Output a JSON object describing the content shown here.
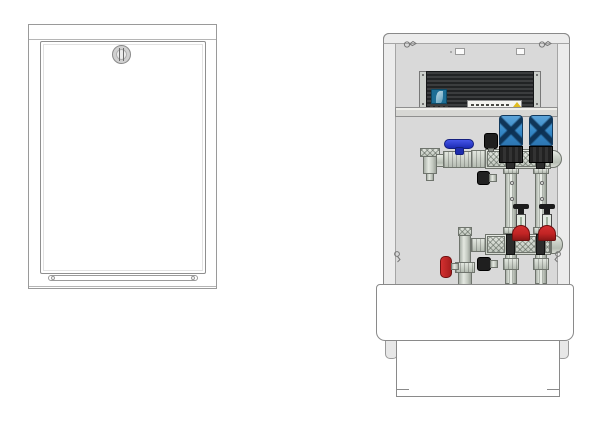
{
  "page": {
    "background": "#ffffff",
    "description": "Technical illustration of a flush-mounted underfloor-heating manifold cabinet: door closed (left) and open cabinet with 2-loop manifold station (right)"
  },
  "colors": {
    "outline": "#8a8a8a",
    "panel_line": "#a5a5a5",
    "cabinet_body": "#d9d9d9",
    "cabinet_frame": "#ececec",
    "box_black": "#2a2c2d",
    "logo_blue": "#1d6e95",
    "actuator_blue": "#3487c6",
    "valve_blue": "#2a3bd2",
    "valve_red": "#c32424",
    "flowmeter_red": "#c22424",
    "metal": "#c6ccc4",
    "metal_edge": "#6f746d",
    "label_bg": "#f4f4ef",
    "warning_yellow": "#e0bc20"
  },
  "left_cabinet": {
    "name": "cabinet front view, door closed",
    "lock": "coin-slot quarter-turn lock",
    "bottom_screw_count": 2
  },
  "right_cabinet": {
    "name": "cabinet open, 2-circuit heating manifold installed",
    "top_mount_keyholes": 2,
    "wall_slots": 2,
    "electronics_box": {
      "style": "black finned enclosure",
      "logo": "blue brand logo (fine print illegible)",
      "warning_label": "white strip with yellow warning triangle (fine print illegible)"
    },
    "mounting_rail": "horizontal support rail",
    "actuator_count": 2,
    "supply_valve": "blue lever ball valve",
    "return_valve": "red lever ball valve",
    "flow_meter_count": 2,
    "loop_pipe_count": 2,
    "base": "bottom cover band with telescopic base extension"
  }
}
